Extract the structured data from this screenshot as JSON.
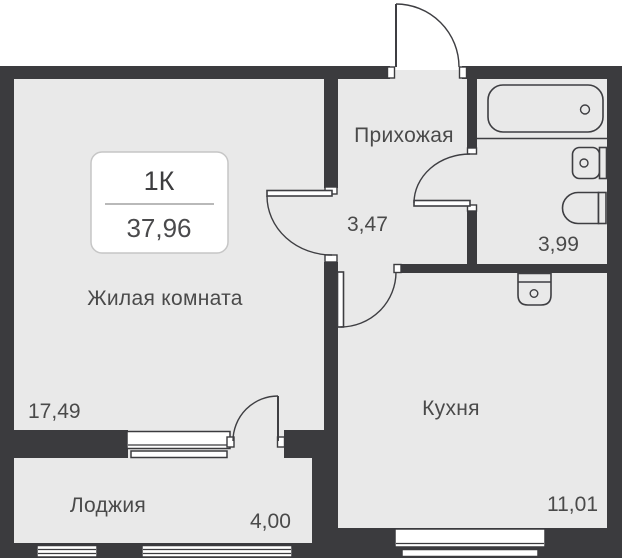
{
  "unit_card": {
    "type": "1К",
    "area": "37,96"
  },
  "rooms": {
    "living": {
      "name": "Жилая комната",
      "area": "17,49"
    },
    "hallway": {
      "name": "Прихожая",
      "area": "3,47"
    },
    "bathroom": {
      "area": "3,99"
    },
    "kitchen": {
      "name": "Кухня",
      "area": "11,01"
    },
    "loggia": {
      "name": "Лоджия",
      "area": "4,00"
    }
  },
  "fixtures": [
    "bathtub",
    "washbasin",
    "toilet",
    "kitchen-sink"
  ],
  "colors": {
    "wall": "#3b3b3e",
    "line": "#3e3e42",
    "floor": "#e9e9e9",
    "text": "#4a4a4a",
    "badge-border": "#c6c6c6",
    "badge-divider": "#8f8f8f"
  }
}
